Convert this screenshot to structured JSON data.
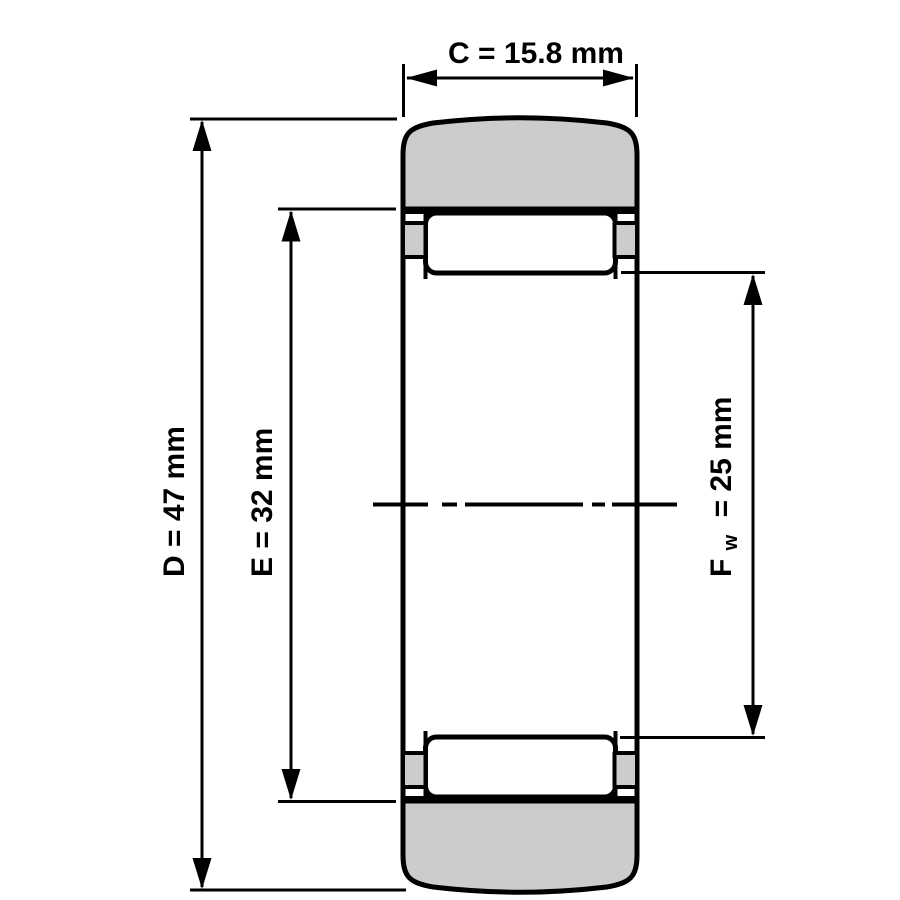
{
  "diagram": {
    "background_color": "#ffffff",
    "line_color": "#000000",
    "section_fill_color": "#cccccc",
    "dimensions": {
      "C": {
        "label": "C = 15.8 mm"
      },
      "D": {
        "label": "D = 47 mm"
      },
      "E": {
        "label": "E = 32 mm"
      },
      "Fw": {
        "symbol": "F",
        "subscript": "w",
        "rest": "= 25 mm"
      }
    }
  }
}
